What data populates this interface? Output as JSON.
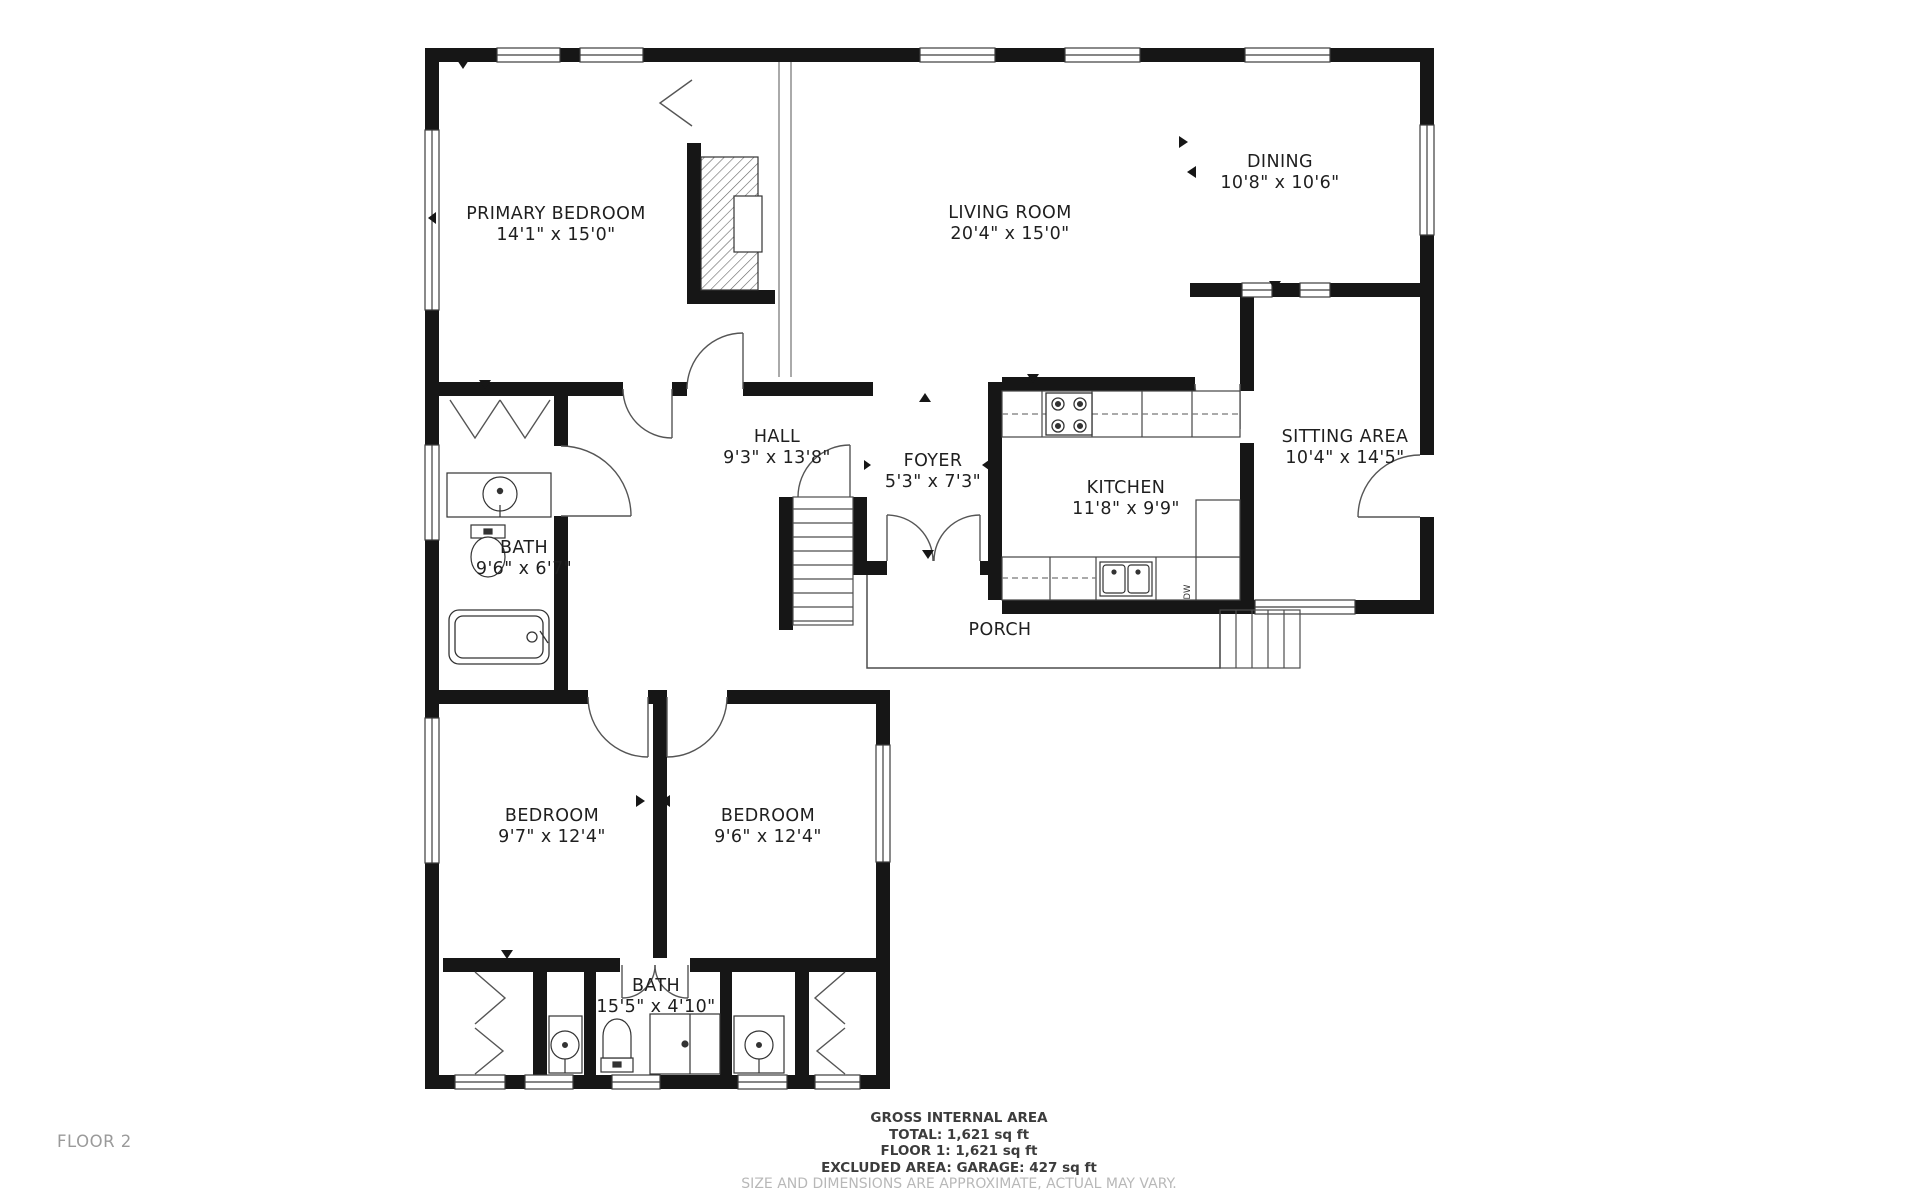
{
  "floor_plan": {
    "floor_label": "FLOOR 2",
    "rooms": [
      {
        "id": "primary-bedroom",
        "name": "PRIMARY BEDROOM",
        "dims": "14'1\" x 15'0\""
      },
      {
        "id": "living-room",
        "name": "LIVING ROOM",
        "dims": "20'4\" x 15'0\""
      },
      {
        "id": "dining",
        "name": "DINING",
        "dims": "10'8\" x 10'6\""
      },
      {
        "id": "sitting-area",
        "name": "SITTING AREA",
        "dims": "10'4\" x 14'5\""
      },
      {
        "id": "hall",
        "name": "HALL",
        "dims": "9'3\" x 13'8\""
      },
      {
        "id": "foyer",
        "name": "FOYER",
        "dims": "5'3\" x 7'3\""
      },
      {
        "id": "kitchen",
        "name": "KITCHEN",
        "dims": "11'8\" x 9'9\""
      },
      {
        "id": "bath-upper",
        "name": "BATH",
        "dims": "9'6\" x 6'7\""
      },
      {
        "id": "porch",
        "name": "PORCH",
        "dims": ""
      },
      {
        "id": "bedroom-left",
        "name": "BEDROOM",
        "dims": "9'7\" x 12'4\""
      },
      {
        "id": "bedroom-right",
        "name": "BEDROOM",
        "dims": "9'6\" x 12'4\""
      },
      {
        "id": "bath-lower",
        "name": "BATH",
        "dims": "15'5\" x 4'10\""
      }
    ],
    "appliances": {
      "dishwasher": "DW"
    }
  },
  "footer": {
    "title": "GROSS INTERNAL AREA",
    "line_total": "TOTAL: 1,621 sq ft",
    "line_floor1": "FLOOR 1: 1,621 sq ft",
    "line_excluded": "EXCLUDED AREA: GARAGE: 427 sq ft",
    "disclaimer": "SIZE AND DIMENSIONS ARE APPROXIMATE, ACTUAL MAY VARY."
  },
  "colors": {
    "wall": "#161616",
    "text": "#1f1f1f",
    "muted": "#9a9a9a",
    "disclaimer": "#b8b8b8"
  }
}
